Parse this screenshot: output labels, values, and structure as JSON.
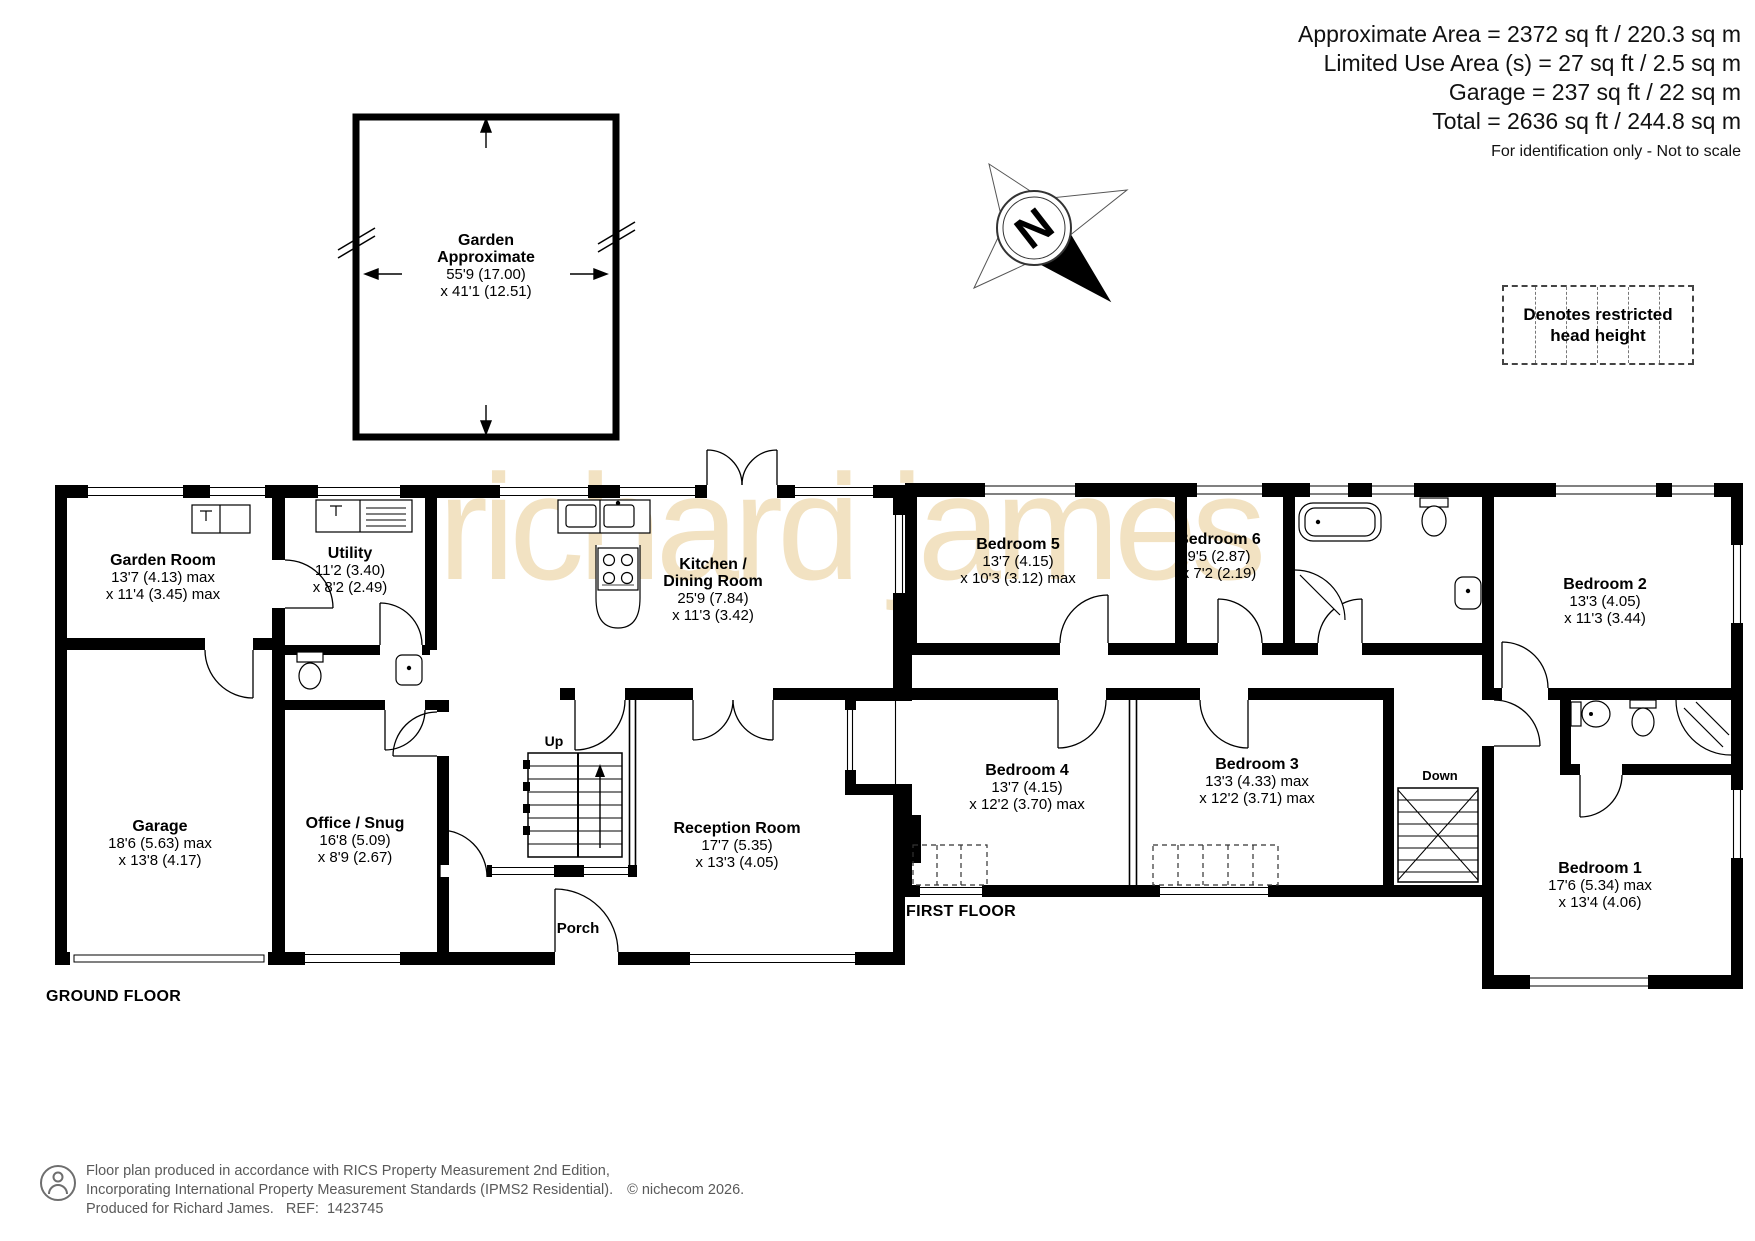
{
  "header": {
    "lines": [
      "Approximate Area = 2372 sq ft / 220.3 sq m",
      "Limited Use Area (s) = 27 sq ft / 2.5 sq m",
      "Garage = 237 sq ft / 22 sq m",
      "Total = 2636 sq ft / 244.8 sq m"
    ],
    "note": "For identification only - Not to scale"
  },
  "legend": {
    "text_line1": "Denotes restricted",
    "text_line2": "head height"
  },
  "compass": {
    "north_label": "N"
  },
  "watermark": "richard james",
  "garden": {
    "name_line1": "Garden",
    "name_line2": "Approximate",
    "dim_line1": "55'9 (17.00)",
    "dim_line2": "x 41'1 (12.51)"
  },
  "ground_floor": {
    "label": "GROUND FLOOR",
    "rooms": {
      "garden_room": {
        "name": "Garden Room",
        "dim1": "13'7 (4.13) max",
        "dim2": "x 11'4 (3.45) max"
      },
      "utility": {
        "name": "Utility",
        "dim1": "11'2 (3.40)",
        "dim2": "x 8'2 (2.49)"
      },
      "kitchen_dining": {
        "name_line1": "Kitchen /",
        "name_line2": "Dining Room",
        "dim1": "25'9 (7.84)",
        "dim2": "x 11'3 (3.42)"
      },
      "garage": {
        "name": "Garage",
        "dim1": "18'6 (5.63) max",
        "dim2": "x 13'8 (4.17)"
      },
      "office_snug": {
        "name": "Office / Snug",
        "dim1": "16'8 (5.09)",
        "dim2": "x 8'9 (2.67)"
      },
      "reception": {
        "name": "Reception Room",
        "dim1": "17'7 (5.35)",
        "dim2": "x 13'3 (4.05)"
      },
      "porch": {
        "name": "Porch"
      },
      "stairs_label": "Up"
    }
  },
  "first_floor": {
    "label": "FIRST FLOOR",
    "rooms": {
      "bedroom5": {
        "name": "Bedroom 5",
        "dim1": "13'7 (4.15)",
        "dim2": "x 10'3 (3.12) max"
      },
      "bedroom6": {
        "name": "Bedroom 6",
        "dim1": "9'5 (2.87)",
        "dim2": "x 7'2 (2.19)"
      },
      "bedroom2": {
        "name": "Bedroom 2",
        "dim1": "13'3 (4.05)",
        "dim2": "x 11'3 (3.44)"
      },
      "bedroom4": {
        "name": "Bedroom 4",
        "dim1": "13'7 (4.15)",
        "dim2": "x 12'2 (3.70) max"
      },
      "bedroom3": {
        "name": "Bedroom 3",
        "dim1": "13'3 (4.33) max",
        "dim2": "x 12'2 (3.71) max"
      },
      "bedroom1": {
        "name": "Bedroom 1",
        "dim1": "17'6 (5.34) max",
        "dim2": "x 13'4 (4.06)"
      },
      "stairs_label": "Down"
    }
  },
  "footer": {
    "line1": "Floor plan produced in accordance with RICS Property Measurement 2nd Edition,",
    "line2": "Incorporating International Property Measurement Standards (IPMS2 Residential).",
    "copyright": "© nichecom 2026.",
    "line3": "Produced for Richard James.   REF:  1423745"
  },
  "colors": {
    "wall": "#000000",
    "watermark": "#f2e2c2",
    "footer_text": "#595959"
  }
}
